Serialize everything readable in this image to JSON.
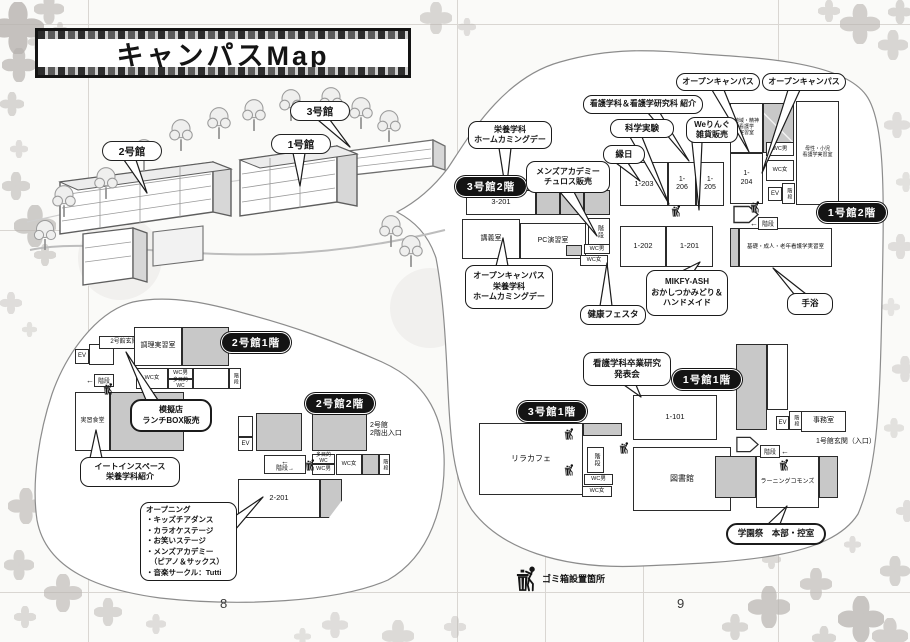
{
  "title": "キャンパスMap",
  "page_numbers": {
    "left": "8",
    "right": "9"
  },
  "legend": {
    "trash": "ゴミ箱設置箇所"
  },
  "buildings": {
    "b1": "1号館",
    "b2": "2号館",
    "b3": "3号館"
  },
  "floor_labels": {
    "b3f2": "3号館2階",
    "b1f2": "1号館2階",
    "b1f1": "1号館1階",
    "b3f1": "3号館1階",
    "b2f1": "2号館1階",
    "b2f2": "2号館2階"
  },
  "rooms": {
    "r3_201": "3-201",
    "lecture": "講義室",
    "pc_room": "PC演習室",
    "r1_203": "1-203",
    "r1_206": "1-\n206",
    "r1_205": "1-\n205",
    "r1_204": "1-\n204",
    "r1_202": "1-202",
    "r1_201": "1-201",
    "r1_101": "1-101",
    "chiiki": "地域・精神\n看護学\n実習室",
    "bosei": "母性・小児\n看護学実習室",
    "kiso": "基礎・成人・老年看護学実習室",
    "library": "図書館",
    "rila": "リラカフェ",
    "office": "事務室",
    "learning": "ラーニングコモンズ",
    "cooking": "調理実習室",
    "dining": "実習食堂",
    "r2_201": "2-201",
    "ent2": "2号館玄関",
    "ent1": "1号館玄関（入口）",
    "ent2f2": "2号館\n2階出入口",
    "wc_m": "WC男",
    "wc_f": "WC女",
    "wc_multi": "多目的WC",
    "ev": "EV",
    "stairs": "階段"
  },
  "callouts": {
    "eiyo_home": "栄養学科\nホームカミングデー",
    "mens_churros": "メンズアカデミー\nチュロス販売",
    "kango_intro": "看護学科＆看護学研究科 紹介",
    "kagaku": "科学実験",
    "ennichi": "縁日",
    "wering": "Weりんぐ\n雑貨販売",
    "open_campus_1": "オープンキャンパス",
    "open_campus_2": "オープンキャンパス",
    "oc_eiyo_home": "オープンキャンパス\n栄養学科\nホームカミングデー",
    "kenko": "健康フェスタ",
    "mikfy": "MIKFY-ASH\nおかしつかみどり＆\nハンドメイド",
    "shuyoku": "手浴",
    "sotsugyo": "看護学科卒業研究\n発表会",
    "gakuensai": "学園祭　本部・控室",
    "mogiten": "模擬店\nランチBOX販売",
    "eatin": "イートインスペース\n栄養学科紹介",
    "opening": "オープニング\n・キッズチアダンス\n・カラオケステージ\n・お笑いステージ\n・メンズアカデミー\n　（ピアノ＆サックス）\n・音楽サークル：Tutti"
  },
  "icons": {
    "arrow_left": "←",
    "arrow_right": "→"
  }
}
